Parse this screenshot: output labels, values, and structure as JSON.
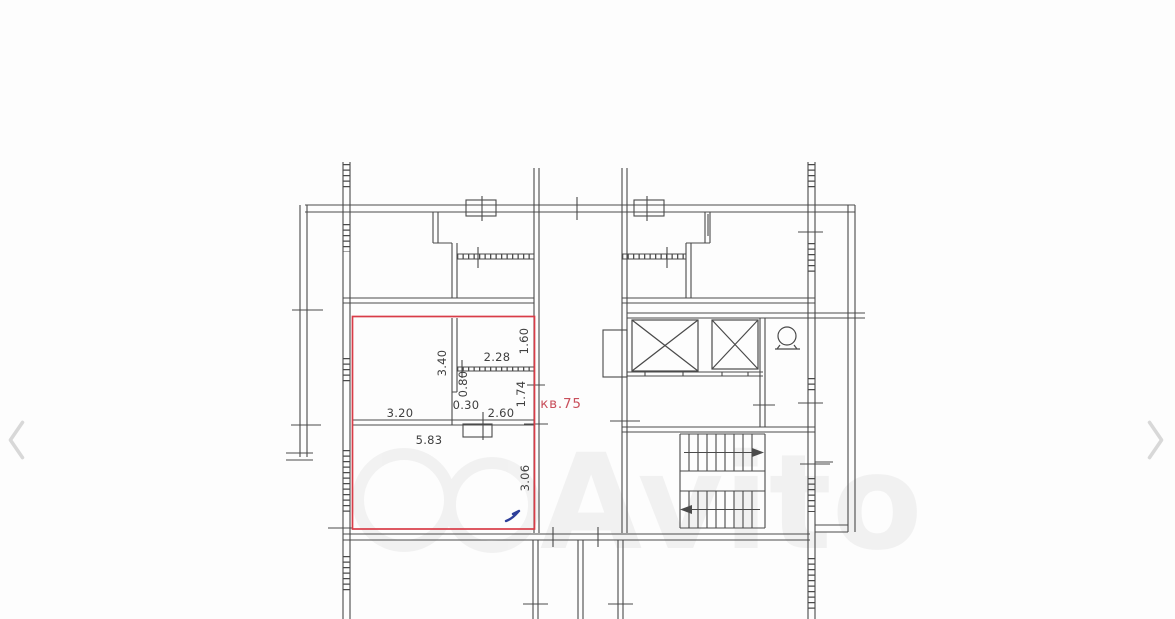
{
  "viewer": {
    "prev_label": "‹",
    "next_label": "›",
    "chevron_color": "#d8d8d8"
  },
  "floor_plan": {
    "apartment_label": "кв.75",
    "watermark": "Avito",
    "colors": {
      "line": "#4a4a4a",
      "text": "#3f3f3f",
      "highlight_red": "#d93c48",
      "label_red": "#c9505c",
      "pen_mark_blue": "#2e3f9a"
    },
    "dimensions": {
      "upper_room_depth": "3.40",
      "upper_room_width": "2.28",
      "right_niche_a": "1.60",
      "closet": "0.80",
      "offset": "0.30",
      "lower_partition_width": "2.60",
      "right_niche_b": "1.74",
      "left_partition_width": "3.20",
      "main_room_width": "5.83",
      "main_room_depth": "3.06"
    }
  }
}
